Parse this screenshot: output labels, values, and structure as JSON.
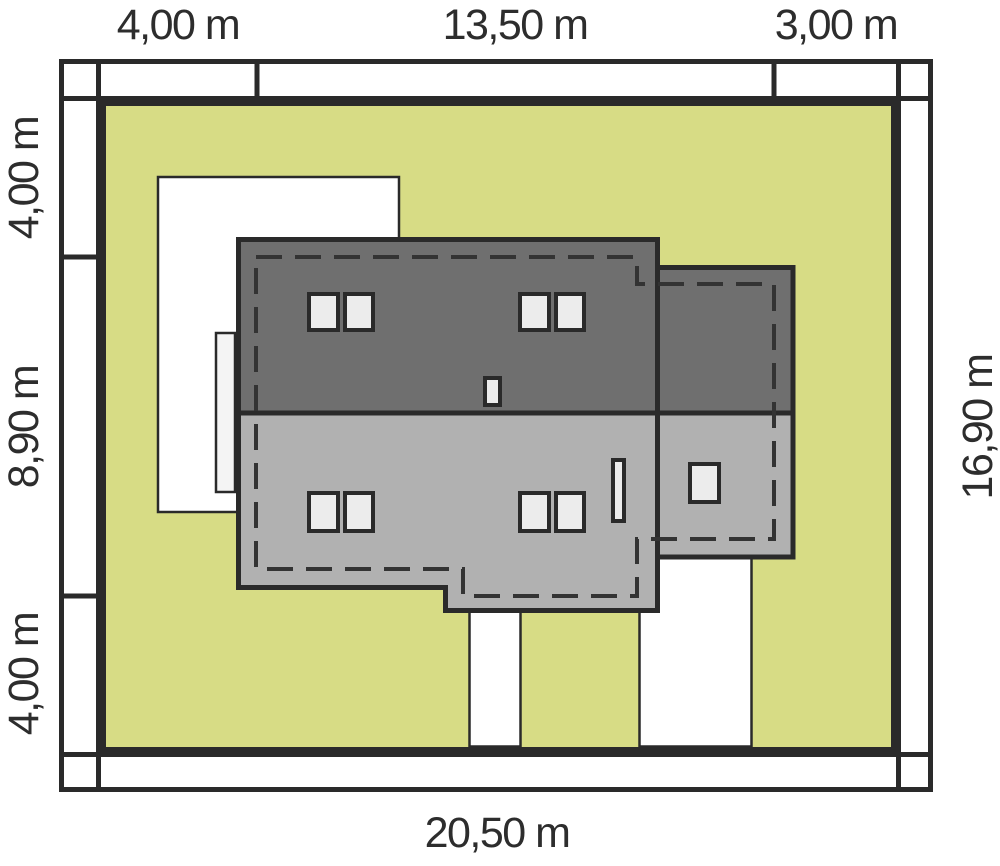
{
  "site_plan": {
    "description": "house site plan with plot setback dimensions",
    "dimensions": {
      "top": [
        {
          "id": "top-left-setback",
          "label": "4,00 m"
        },
        {
          "id": "top-house-span",
          "label": "13,50 m"
        },
        {
          "id": "top-right-setback",
          "label": "3,00 m"
        }
      ],
      "left": [
        {
          "id": "left-top-setback",
          "label": "4,00 m"
        },
        {
          "id": "left-house-depth",
          "label": "8,90 m"
        },
        {
          "id": "left-bottom-setback",
          "label": "4,00 m"
        }
      ],
      "right": [
        {
          "id": "plot-depth",
          "label": "16,90 m"
        }
      ],
      "bottom": [
        {
          "id": "plot-width",
          "label": "20,50 m"
        }
      ]
    },
    "colors": {
      "background": "#ffffff",
      "plot_green": "#d7dc85",
      "roof_dark_gray": "#6f6f6f",
      "roof_light_gray": "#b1b1b1",
      "outline_black": "#2a2a2a",
      "eaves_dash": "#333333",
      "window_fill": "#ececec",
      "paving_white": "#ffffff",
      "terrace_fill": "#f4f4f4",
      "label_text": "#2d2d2d"
    }
  }
}
